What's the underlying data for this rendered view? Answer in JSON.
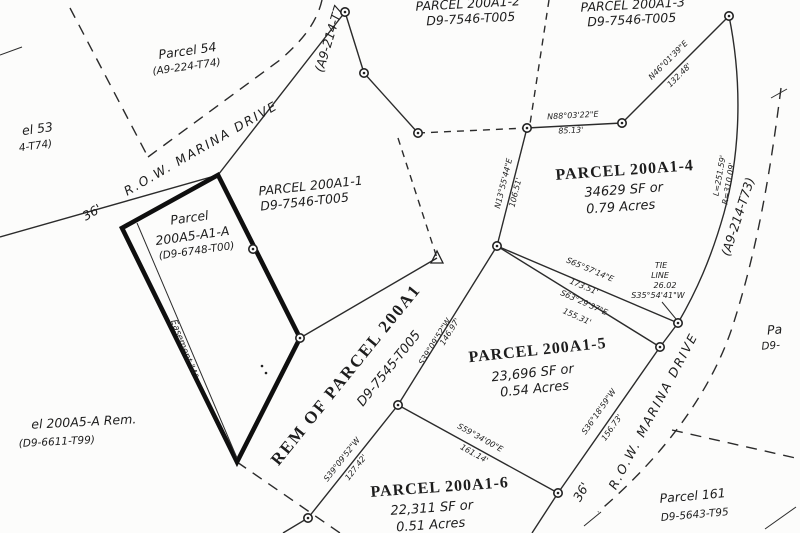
{
  "map": {
    "roads": {
      "marina_upper": "R.O.W. MARINA DRIVE",
      "marina_lower": "R.O.W. MARINA DRIVE",
      "width_upper": "36'",
      "width_lower": "36'",
      "plat_ref_right": "(A9-214-T73)",
      "plat_ref_top_left": "(A9-214-T7",
      "curve_length": "L=251.59'",
      "curve_radius": "R=310.09'"
    },
    "parcels": {
      "p54": {
        "name": "Parcel 54",
        "ref": "(A9-224-T74)"
      },
      "p53": {
        "name": "el 53",
        "ref": "4-T74)"
      },
      "p200a1_2": {
        "name": "PARCEL 200A1-2",
        "ref": "D9-7546-T005"
      },
      "p200a1_3": {
        "name": "PARCEL 200A1-3",
        "ref": "D9-7546-T005"
      },
      "p200a1_1": {
        "name": "PARCEL 200A1-1",
        "ref": "D9-7546-T005"
      },
      "p200a5_a1_a": {
        "name1": "Parcel",
        "name2": "200A5-A1-A",
        "ref": "(D9-6748-T00)"
      },
      "p200a1_4": {
        "name": "PARCEL 200A1-4",
        "area_sf": "34629 SF or",
        "area_ac": "0.79 Acres"
      },
      "p200a1_5": {
        "name": "PARCEL 200A1-5",
        "area_sf": "23,696 SF or",
        "area_ac": "0.54 Acres"
      },
      "p200a1_6": {
        "name": "PARCEL 200A1-6",
        "area_sf": "22,311 SF or",
        "area_ac": "0.51 Acres"
      },
      "rem_200a1": {
        "name": "REM OF PARCEL 200A1",
        "ref": "D9-7545-T005"
      },
      "p200a5_a_rem": {
        "name": "el 200A5-A Rem.",
        "ref": "(D9-6611-T99)"
      },
      "p161": {
        "name": "Parcel 161",
        "ref": "D9-5643-T95"
      },
      "p_edge_right": {
        "name": "Pa",
        "ref": "D9-"
      }
    },
    "easement": {
      "label": "Easement \"A\""
    },
    "tie_line": {
      "l1": "TIE",
      "l2": "LINE",
      "l3": "26.02",
      "l4": "S35°54'41\"W"
    },
    "bearings": {
      "n46": {
        "b": "N46°01'39\"E",
        "d": "132.48'"
      },
      "n88": {
        "b": "N88°03'22\"E",
        "d": "85.13'"
      },
      "n13": {
        "b": "N13°55'44\"E",
        "d": "106.51'"
      },
      "s65": {
        "b": "S65°57'14\"E",
        "d": "173.51'"
      },
      "s63": {
        "b": "S63°29'37\"E",
        "d": "155.31'"
      },
      "s39_146": {
        "b": "S39°09'52\"W",
        "d": "146.97'"
      },
      "s39_127": {
        "b": "S39°09'52\"W",
        "d": "127.42'"
      },
      "s59": {
        "b": "S59°34'00\"E",
        "d": "161.14'"
      },
      "s36": {
        "b": "S36°18'59\"W",
        "d": "156.73'"
      }
    }
  }
}
